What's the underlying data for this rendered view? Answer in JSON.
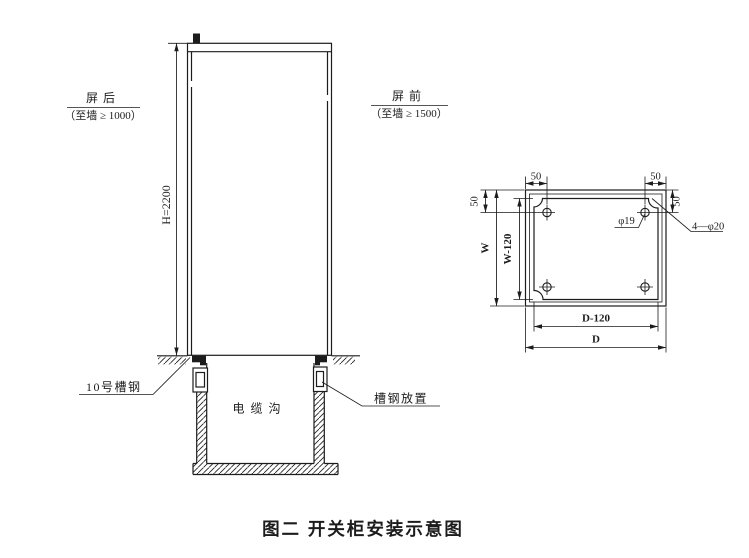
{
  "colors": {
    "ink": "#1c1c1c",
    "bg": "#ffffff"
  },
  "caption": "图二  开关柜安装示意图",
  "elevation": {
    "rear_clearance": {
      "title": "屏后",
      "subtitle": "（至墙 ≥ 1000）"
    },
    "front_clearance": {
      "title": "屏前",
      "subtitle": "（至墙 ≥ 1500）"
    },
    "height_dim": "H=2200",
    "channel_steel_label": "10号槽钢",
    "channel_place_label": "槽钢放置",
    "cable_trench_label": "电缆沟"
  },
  "plan": {
    "dims": {
      "offset_top_left": "50",
      "offset_top_right": "50",
      "offset_left": "50",
      "offset_right": "50",
      "width_overall": "W",
      "width_bolt": "W-120",
      "depth_bolt": "D-120",
      "depth_overall": "D"
    },
    "hole_dia_label": "φ19",
    "bolt_holes_label": "4—φ20"
  }
}
